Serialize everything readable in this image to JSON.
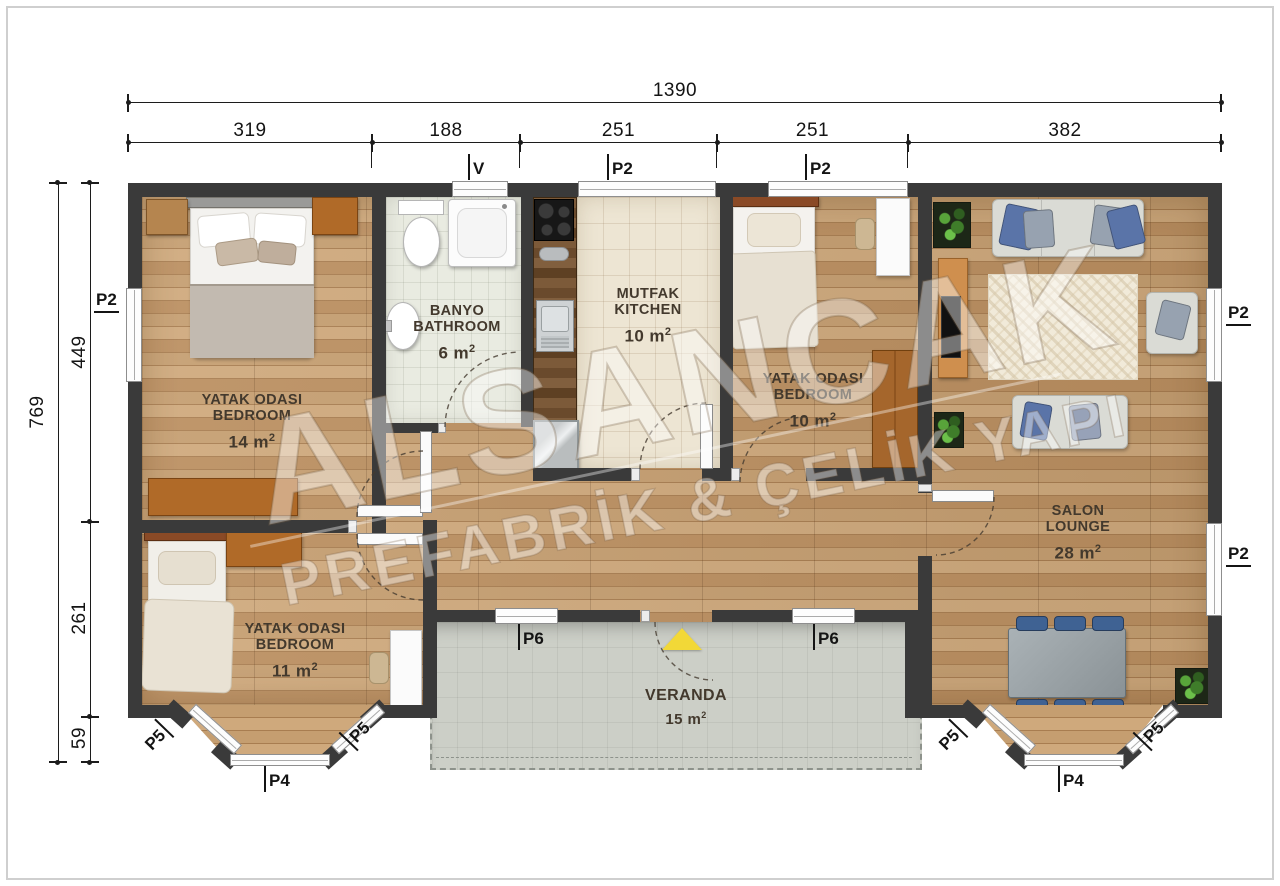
{
  "colors": {
    "wall": "#3a3a3a",
    "wood": "#c09a6e",
    "bath_tile": "#e9ebe1",
    "kitchen_tile": "#ede5d3",
    "veranda": "#cccfc7",
    "arrow": "#f2d837",
    "dim": "#1c1c1c"
  },
  "watermark": {
    "line1": "ALSANCAK",
    "line2": "PREFABRİK & ÇELİK YAPI"
  },
  "dims": {
    "top_total": "1390",
    "top_segments": [
      "319",
      "188",
      "251",
      "251",
      "382"
    ],
    "left_total": "769",
    "left_segments": [
      "449",
      "261",
      "59"
    ]
  },
  "codes": {
    "v": "V",
    "p2": "P2",
    "p4": "P4",
    "p5": "P5",
    "p6": "P6"
  },
  "rooms": {
    "bedroom14": {
      "tr": "YATAK ODASI",
      "en": "BEDROOM",
      "area": "14 m",
      "sup": "2"
    },
    "bathroom": {
      "tr": "BANYO",
      "en": "BATHROOM",
      "area": "6 m",
      "sup": "2"
    },
    "kitchen": {
      "tr": "MUTFAK",
      "en": "KITCHEN",
      "area": "10 m",
      "sup": "2"
    },
    "bedroom10": {
      "tr": "YATAK ODASI",
      "en": "BEDROOM",
      "area": "10 m",
      "sup": "2"
    },
    "lounge": {
      "tr": "SALON",
      "en": "LOUNGE",
      "area": "28 m",
      "sup": "2"
    },
    "bedroom11": {
      "tr": "YATAK ODASI",
      "en": "BEDROOM",
      "area": "11 m",
      "sup": "2"
    },
    "veranda": {
      "name": "VERANDA",
      "area": "15 m",
      "sup": "2"
    }
  }
}
